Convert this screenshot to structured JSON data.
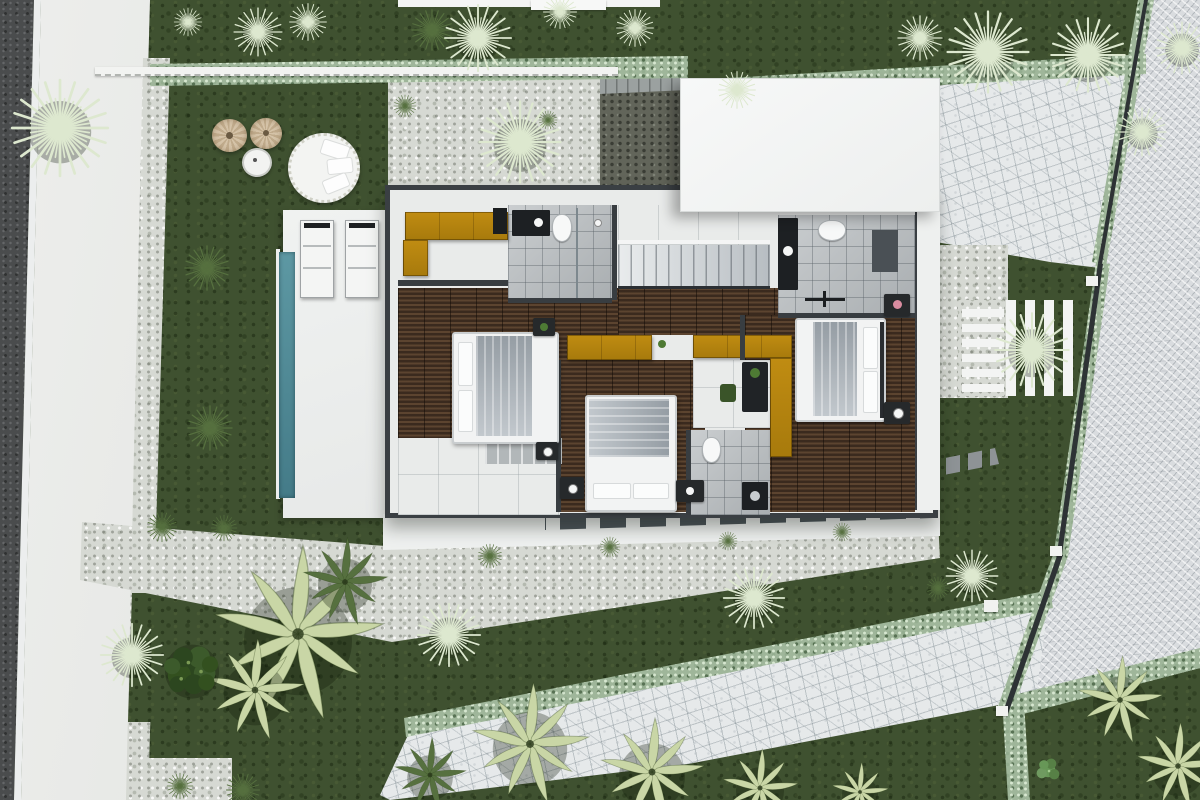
{
  "scene": {
    "type": "architectural-site-plan",
    "view": "top-down-aerial-3d-render",
    "width": 1200,
    "height": 800
  },
  "palette": {
    "lawn": "#3f5130",
    "gravel": "#d6d9d3",
    "gravel_dark": "#62655a",
    "sidewalk": "#e8e9e6",
    "asphalt": "#4a4c4d",
    "flagstone": "#e6e9ea",
    "herringbone_paving": "#d9dcdf",
    "hedge": "#9fb69a",
    "wood_floor": "#4b3829",
    "bathroom_tile": "#b6bbbe",
    "white_tile": "#e9ebea",
    "deck": "#edefee",
    "roof": "#f5f6f6",
    "wall": "#3a3f43",
    "wardrobe_mustard": "#b5830f",
    "pool": "#4d8894",
    "bed_linen": "#f2f3f3",
    "blanket_gray": "#9aa1a8"
  },
  "site": {
    "regions": [
      {
        "name": "road",
        "material": "asphalt"
      },
      {
        "name": "road-marking",
        "material": "white-paint"
      },
      {
        "name": "sidewalk",
        "material": "concrete"
      },
      {
        "name": "lawn",
        "material": "grass"
      },
      {
        "name": "driveway",
        "material": "herringbone-pavers"
      },
      {
        "name": "patio-north-east",
        "material": "flagstone"
      },
      {
        "name": "garden-path-south",
        "material": "flagstone"
      },
      {
        "name": "gravel-bed-north",
        "material": "gravel"
      },
      {
        "name": "gravel-band-south",
        "material": "gravel"
      },
      {
        "name": "hedges",
        "material": "shrub"
      },
      {
        "name": "pool",
        "material": "water"
      },
      {
        "name": "pool-deck",
        "material": "white-concrete"
      },
      {
        "name": "garden-steps",
        "material": "white-slats"
      }
    ]
  },
  "house": {
    "rooms": [
      {
        "name": "bedroom-west"
      },
      {
        "name": "bedroom-south"
      },
      {
        "name": "bedroom-east"
      },
      {
        "name": "bathroom-north-west"
      },
      {
        "name": "bathroom-north-east"
      },
      {
        "name": "bathroom-south"
      },
      {
        "name": "hallway"
      },
      {
        "name": "staircase"
      },
      {
        "name": "terrace-east"
      },
      {
        "name": "terrace-south"
      },
      {
        "name": "roof-section"
      }
    ],
    "furniture": [
      {
        "name": "double-bed",
        "count": 3
      },
      {
        "name": "wardrobe-mustard",
        "count": 4
      },
      {
        "name": "nightstand",
        "count": 5
      },
      {
        "name": "toilet",
        "count": 3
      },
      {
        "name": "vanity",
        "count": 3
      },
      {
        "name": "desk-with-chair",
        "count": 1
      },
      {
        "name": "sun-lounger",
        "count": 2
      },
      {
        "name": "round-daybed",
        "count": 1
      },
      {
        "name": "wicker-pouf",
        "count": 2
      },
      {
        "name": "side-table",
        "count": 1
      }
    ]
  },
  "plants": [
    {
      "type": "yucca",
      "tone": "silver",
      "x": 60,
      "y": 128,
      "r": 52
    },
    {
      "type": "yucca",
      "tone": "silver",
      "x": 258,
      "y": 32,
      "r": 26
    },
    {
      "type": "yucca",
      "tone": "silver",
      "x": 308,
      "y": 22,
      "r": 20
    },
    {
      "type": "yucca",
      "tone": "silver",
      "x": 188,
      "y": 22,
      "r": 15
    },
    {
      "type": "yucca",
      "tone": "dark",
      "x": 432,
      "y": 30,
      "r": 22
    },
    {
      "type": "yucca",
      "tone": "silver",
      "x": 478,
      "y": 38,
      "r": 36
    },
    {
      "type": "yucca",
      "tone": "silver",
      "x": 560,
      "y": 12,
      "r": 18
    },
    {
      "type": "yucca",
      "tone": "silver",
      "x": 635,
      "y": 28,
      "r": 20
    },
    {
      "type": "yucca",
      "tone": "silver",
      "x": 737,
      "y": 90,
      "r": 20
    },
    {
      "type": "yucca",
      "tone": "silver",
      "x": 920,
      "y": 38,
      "r": 24
    },
    {
      "type": "yucca",
      "tone": "silver",
      "x": 988,
      "y": 52,
      "r": 44
    },
    {
      "type": "yucca",
      "tone": "silver",
      "x": 1088,
      "y": 55,
      "r": 40
    },
    {
      "type": "yucca",
      "tone": "silver",
      "x": 1182,
      "y": 48,
      "r": 28
    },
    {
      "type": "yucca",
      "tone": "silver",
      "x": 1142,
      "y": 132,
      "r": 26
    },
    {
      "type": "yucca",
      "tone": "silver",
      "x": 520,
      "y": 142,
      "r": 44
    },
    {
      "type": "yucca",
      "tone": "dark",
      "x": 405,
      "y": 106,
      "r": 12
    },
    {
      "type": "yucca",
      "tone": "dark",
      "x": 548,
      "y": 120,
      "r": 10
    },
    {
      "type": "yucca",
      "tone": "silver",
      "x": 1032,
      "y": 350,
      "r": 40
    },
    {
      "type": "yucca",
      "tone": "silver",
      "x": 972,
      "y": 576,
      "r": 28
    },
    {
      "type": "yucca",
      "tone": "silver",
      "x": 449,
      "y": 635,
      "r": 34
    },
    {
      "type": "yucca",
      "tone": "silver",
      "x": 754,
      "y": 598,
      "r": 33
    },
    {
      "type": "yucca",
      "tone": "silver",
      "x": 132,
      "y": 655,
      "r": 34
    },
    {
      "type": "yucca",
      "tone": "dark",
      "x": 207,
      "y": 268,
      "r": 24
    },
    {
      "type": "yucca",
      "tone": "dark",
      "x": 210,
      "y": 428,
      "r": 24
    },
    {
      "type": "yucca",
      "tone": "dark",
      "x": 162,
      "y": 527,
      "r": 16
    },
    {
      "type": "yucca",
      "tone": "dark",
      "x": 224,
      "y": 528,
      "r": 14
    },
    {
      "type": "tuft",
      "tone": "dark",
      "x": 490,
      "y": 556,
      "r": 13
    },
    {
      "type": "tuft",
      "tone": "dark",
      "x": 610,
      "y": 547,
      "r": 11
    },
    {
      "type": "tuft",
      "tone": "dark",
      "x": 728,
      "y": 541,
      "r": 10
    },
    {
      "type": "tuft",
      "tone": "dark",
      "x": 842,
      "y": 532,
      "r": 10
    },
    {
      "type": "tuft",
      "tone": "dark",
      "x": 938,
      "y": 588,
      "r": 12
    },
    {
      "type": "tuft",
      "tone": "dark",
      "x": 243,
      "y": 790,
      "r": 18
    },
    {
      "type": "tuft",
      "tone": "dark",
      "x": 180,
      "y": 786,
      "r": 14
    },
    {
      "type": "palm",
      "tone": "light",
      "x": 298,
      "y": 634,
      "r": 90
    },
    {
      "type": "palm",
      "tone": "light",
      "x": 255,
      "y": 690,
      "r": 52
    },
    {
      "type": "palm",
      "tone": "light",
      "x": 530,
      "y": 744,
      "r": 62
    },
    {
      "type": "palm",
      "tone": "light",
      "x": 652,
      "y": 772,
      "r": 55
    },
    {
      "type": "palm",
      "tone": "light",
      "x": 760,
      "y": 788,
      "r": 40
    },
    {
      "type": "palm",
      "tone": "light",
      "x": 1120,
      "y": 700,
      "r": 45
    },
    {
      "type": "palm",
      "tone": "light",
      "x": 1178,
      "y": 766,
      "r": 44
    },
    {
      "type": "palm",
      "tone": "light",
      "x": 860,
      "y": 792,
      "r": 30
    },
    {
      "type": "palm",
      "tone": "dark",
      "x": 430,
      "y": 775,
      "r": 38
    },
    {
      "type": "palm",
      "tone": "dark",
      "x": 345,
      "y": 582,
      "r": 45
    },
    {
      "type": "bush",
      "tone": "dark",
      "x": 192,
      "y": 668,
      "r": 45
    },
    {
      "type": "monstera",
      "tone": "light",
      "x": 1048,
      "y": 770,
      "r": 26
    }
  ]
}
